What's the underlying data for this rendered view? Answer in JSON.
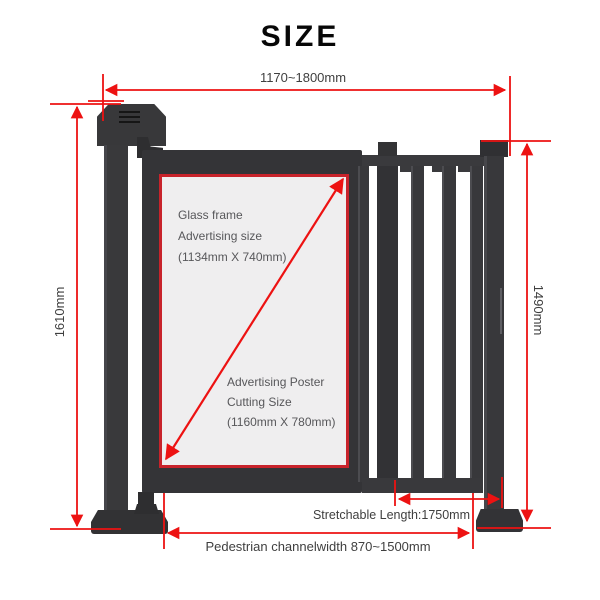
{
  "title": "SIZE",
  "dimensions": {
    "top_width": "1170~1800mm",
    "left_height": "1610mm",
    "right_height": "1490mm",
    "stretchable": "Stretchable Length:1750mm",
    "pedestrian": "Pedestrian channelwidth 870~1500mm"
  },
  "glass_panel": {
    "frame_lines": [
      "Glass frame",
      "Advertising size",
      "(1134mm X 740mm)"
    ],
    "poster_lines": [
      "Advertising Poster",
      "Cutting Size",
      "(1160mm X 780mm)"
    ]
  },
  "colors": {
    "dimension_red": "#ed1212",
    "glass_border_red": "#c8232b",
    "structure_dark": "#38383b",
    "glass_fill": "#efeeef"
  }
}
